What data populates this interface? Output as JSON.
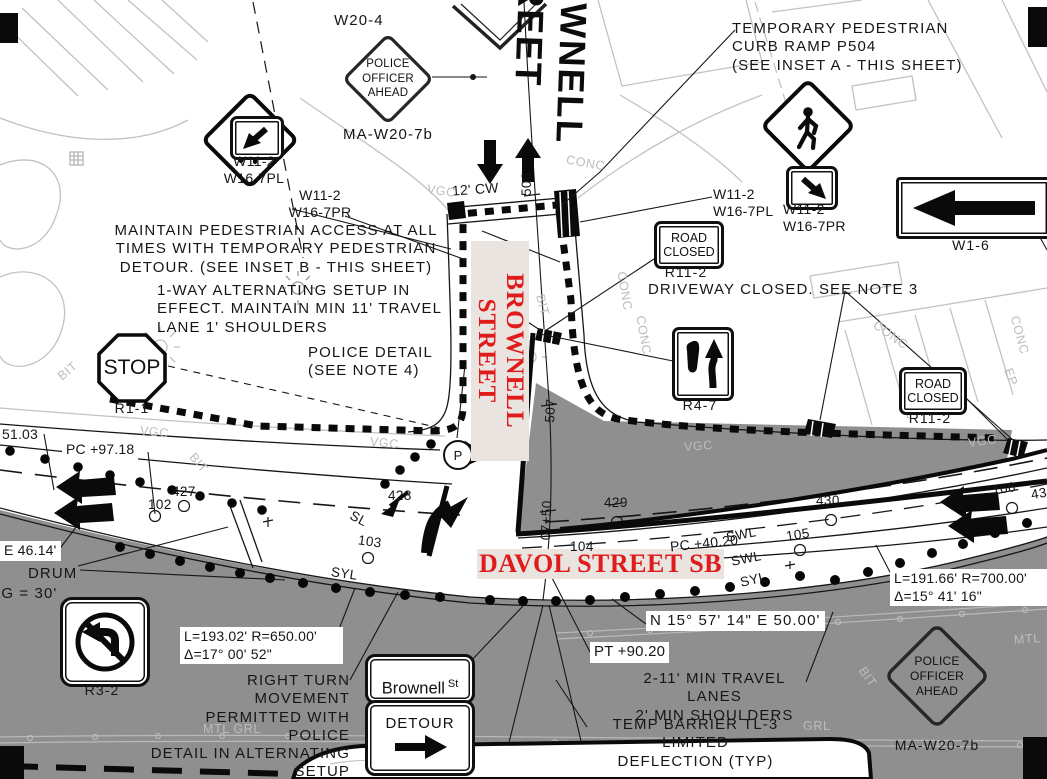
{
  "signs": {
    "w20_4": "W20-4",
    "ma_w20_7b": "MA-W20-7b",
    "police_officer_ahead": "POLICE\nOFFICER\nAHEAD",
    "w11_2": "W11-2",
    "w16_7pl": "W16-7PL",
    "w16_7pr": "W16-7PR",
    "stop": "STOP",
    "r1_1": "R1-1",
    "road_closed": "ROAD\nCLOSED",
    "r11_2": "R11-2",
    "r4_7": "R4-7",
    "w1_6": "W1-6",
    "r3_2": "R3-2",
    "detour": "DETOUR",
    "brownell_st": "Brownell",
    "brownell_st_suffix": "St",
    "p_symbol": "P"
  },
  "streets": {
    "brownell_top": "BROWNELL STREET",
    "brownell_red": "BROWNELL STREET",
    "davol_red": "DAVOL STREET SB"
  },
  "notes": {
    "temp_ped_ramp": "TEMPORARY PEDESTRIAN\nCURB RAMP P504\n(SEE INSET A - THIS SHEET)",
    "maintain_ped": "MAINTAIN PEDESTRIAN ACCESS AT ALL\nTIMES WITH TEMPORARY PEDESTRIAN\nDETOUR. (SEE INSET B - THIS SHEET)",
    "one_way": "1-WAY ALTERNATING SETUP IN\nEFFECT. MAINTAIN MIN 11' TRAVEL\nLANE 1' SHOULDERS",
    "police_detail": "POLICE DETAIL\n(SEE NOTE 4)",
    "driveway_closed": "DRIVEWAY CLOSED. SEE NOTE 3",
    "right_turn": "RIGHT TURN MOVEMENT\nPERMITTED WITH POLICE\nDETAIL IN ALTERNATING\nSETUP",
    "travel_lanes": "2-11' MIN TRAVEL LANES\n2' MIN SHOULDERS",
    "temp_barrier": "TEMP BARRIER TL-3 LIMITED\nDEFLECTION (TYP)",
    "drum": "DRUM",
    "drum_spacing": "SPACING = 30'"
  },
  "geometry": {
    "curve1": "L=193.02' R=650.00'\nΔ=17° 00' 52\"",
    "curve2": "L=191.66' R=700.00'\nΔ=15° 41' 16\"",
    "bearing": "N 15° 57' 14\" E   50.00'",
    "pc1": "PC +97.18",
    "pc2": "PC +40.20",
    "pt": "PT +90.20",
    "sta_5103": "51.03",
    "e_4614": "E   46.14'",
    "cw": "12' CW"
  },
  "stations": {
    "s102": "102",
    "s103": "103",
    "s104": "104",
    "s105": "105",
    "s106": "106",
    "s427": "427",
    "s428": "428",
    "s429": "429",
    "s430": "430",
    "s431_partial": "43",
    "s506": "506",
    "s507": "507",
    "s0750": "07+50"
  },
  "surface": {
    "bit": "BIT",
    "conc": "CONC",
    "vgc": "VGC",
    "swl": "SWL",
    "syl": "SYL",
    "sl": "SL",
    "mtl": "MTL",
    "grl": "GRL",
    "mtl_grl": "MTL  GRL",
    "ep": "EP"
  },
  "colors": {
    "street_name_red": "#e01b1b",
    "closed_area_gray": "#8f8f8f",
    "light_linework": "#bdbdbd",
    "ink": "#111111"
  }
}
